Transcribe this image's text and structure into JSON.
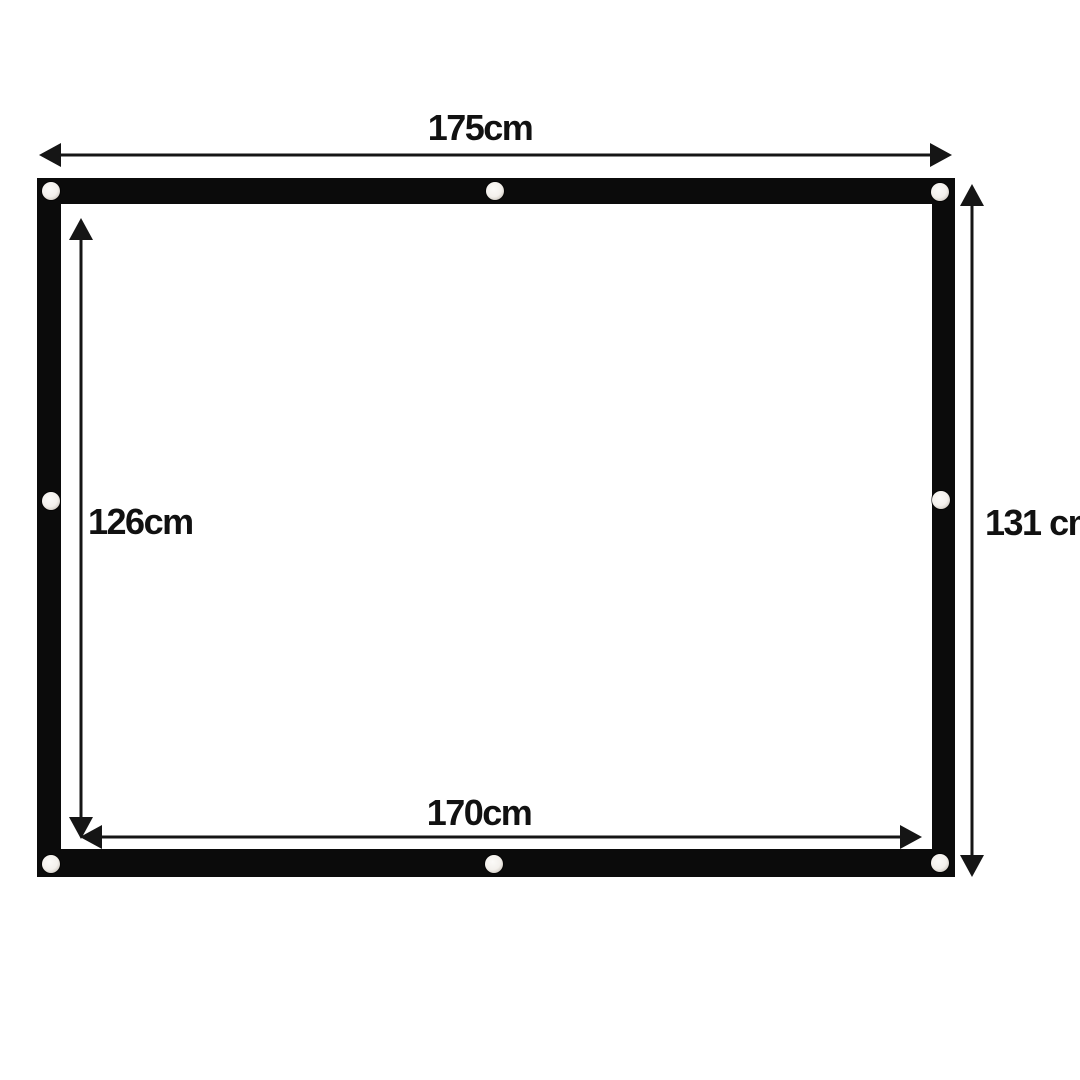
{
  "diagram": {
    "type": "product-dimension-diagram",
    "subject": "projection screen with black border and grommets",
    "dimensions": {
      "outer_width": "175cm",
      "outer_height": "131 cm",
      "inner_height": "126cm",
      "inner_width": "170cm"
    },
    "grommet_count": 8,
    "colors": {
      "background": "#ffffff",
      "frame": "#0b0b0b",
      "screen_surface": "#ffffff",
      "arrows_and_text": "#151515",
      "grommet_center": "#f3f0ec",
      "grommet_ring": "#948d84"
    }
  }
}
